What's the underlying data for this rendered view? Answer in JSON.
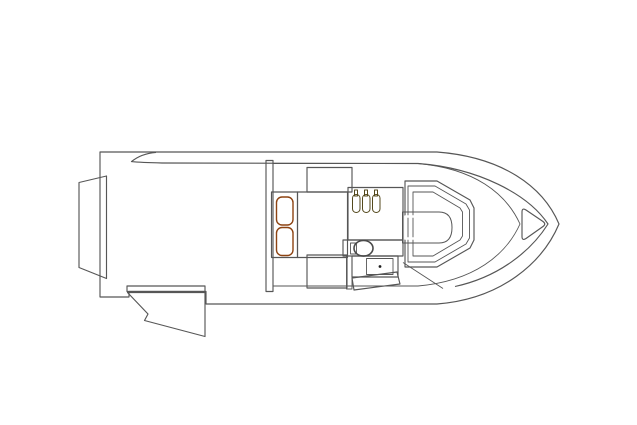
{
  "scene": {
    "kind": "boat-deck-plan",
    "orientation": "top-down plan view, bow pointing right",
    "components": [
      "hull",
      "gunwale-line",
      "engine-pod",
      "swim-platform",
      "transom-step",
      "transom-door-open",
      "cockpit-deck",
      "cockpit-bulkhead",
      "aft-table",
      "lounge-seat",
      "cushion-base",
      "seat-cushions",
      "galley-counter",
      "galley-bottles",
      "galley-sink",
      "appliance-band",
      "stove",
      "bench-table",
      "angled-bench",
      "helm-console",
      "helm-dash",
      "deck-step-line",
      "bow-hatch"
    ]
  },
  "colors": {
    "background": "#ffffff",
    "hull_white": "#ffffff",
    "deck_gray": "#8d8d8d",
    "bulkhead_gray": "#737373",
    "lounge_tan": "#bdb5a5",
    "table_brown": "#8c6e3f",
    "cushion_orange": "#cd6a28",
    "bottle_olive": "#867943",
    "appliance_dark": "#2d2d2d",
    "dash_dark": "#45453f",
    "console_tan_outer": "#cfc6b4",
    "console_tan_mid": "#c1b8a7",
    "console_tan_panel": "#aba290",
    "white": "#ffffff",
    "stove_dot": "#1c1c1c"
  }
}
